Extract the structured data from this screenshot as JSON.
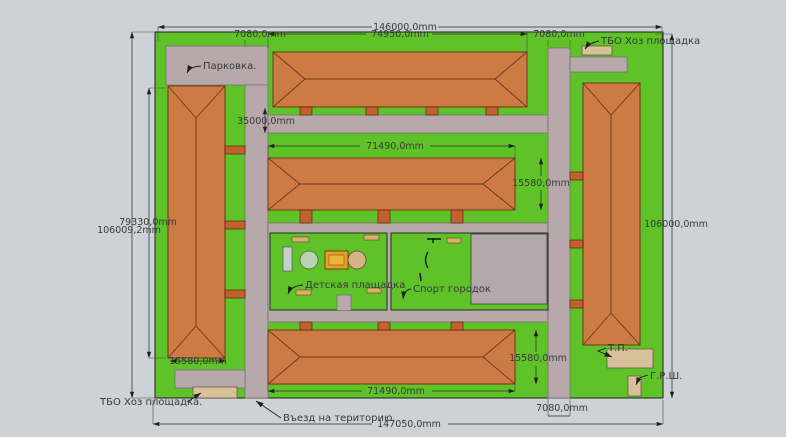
{
  "palette": {
    "background": "#cdd1d8",
    "grass": "#5ec228",
    "road": "#b7a8ab",
    "roof": "#cd7b44",
    "roof_edge": "#6e3716",
    "entry_stub": "#c3602f",
    "sand_pad": "#d8c09a",
    "sport_court": "#b3a8ac",
    "sandbox": "#e4a02a",
    "dim_line": "#2f2f2f",
    "text": "#3a3a3a"
  },
  "labels": {
    "parking": "Парковка.",
    "tbo_top": "ТБО Хоз площадка",
    "tbo_bottom": "ТБО Хоз площадка.",
    "entrance": "Въезд на територию.",
    "playground": "Детская плащадка",
    "sports": "Спорт городок",
    "transformer": "Т.П.",
    "grsh": "Г.Р.Ш."
  },
  "dimensions": {
    "site_width_top": "146000,0mm",
    "top_building_length": "74950,0mm",
    "road_top_left": "7080,0mm",
    "road_top_right": "7080,0mm",
    "road_main": "35000,0mm",
    "left_building_length": "79330,0mm",
    "site_height_left": "106009,2mm",
    "site_height_right": "106000,0mm",
    "mid_building_length": "71490,0mm",
    "mid_building_width": "15580,0mm",
    "left_building_width": "15580,0mm",
    "bottom_building_length": "71490,0mm",
    "bottom_building_width": "15580,0mm",
    "site_width_bottom": "147050,0mm",
    "road_bottom_right": "7080,0mm"
  }
}
